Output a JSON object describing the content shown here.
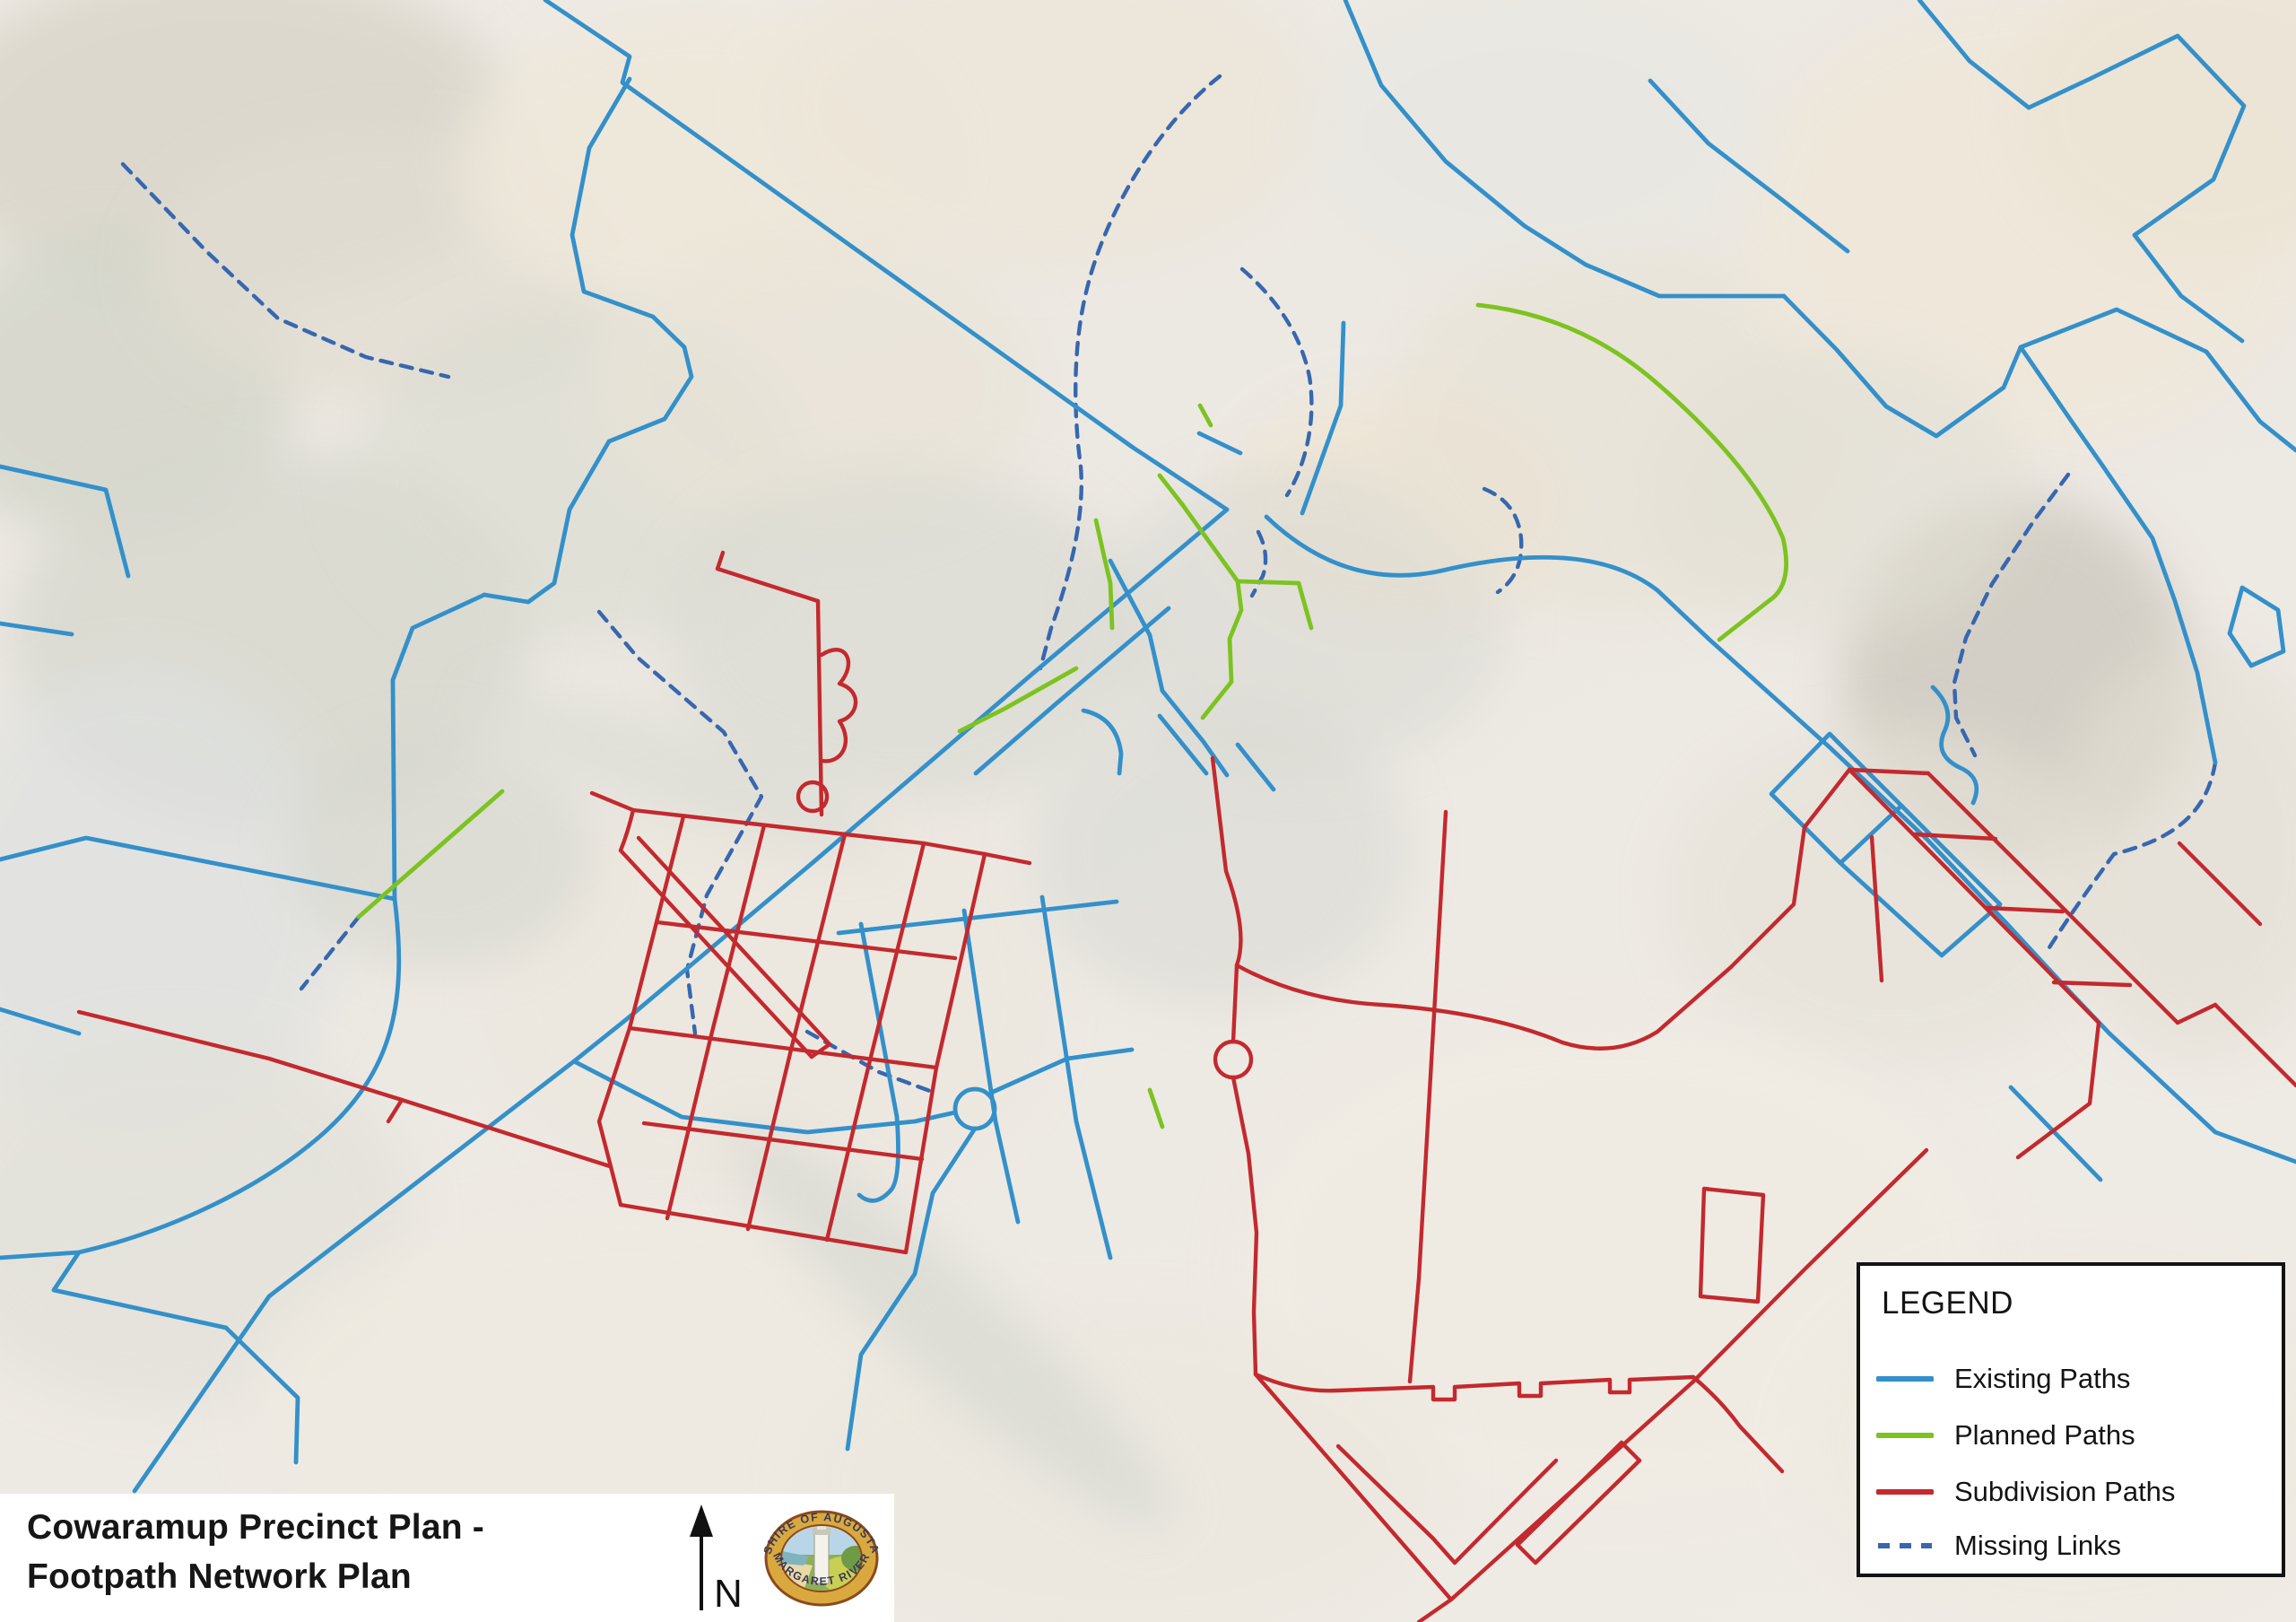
{
  "title": {
    "line1": "Cowaramup Precinct Plan -",
    "line2": "Footpath Network Plan"
  },
  "north": {
    "label": "N"
  },
  "logo": {
    "top_text": "SHIRE OF AUGUSTA",
    "bottom_text": "MARGARET RIVER"
  },
  "legend": {
    "heading": "LEGEND",
    "items": [
      {
        "label": "Existing Paths",
        "style": "solid",
        "color": "#3390CA"
      },
      {
        "label": "Planned Paths",
        "style": "solid",
        "color": "#7CC320"
      },
      {
        "label": "Subdivision Paths",
        "style": "solid",
        "color": "#C3292E"
      },
      {
        "label": "Missing Links",
        "style": "dashed",
        "color": "#3767AF"
      }
    ]
  },
  "map": {
    "colors": {
      "existing": "#3390CA",
      "planned": "#7CC320",
      "subdivision": "#C3292E",
      "missing": "#3767AF"
    },
    "layers": [
      {
        "key": "missing",
        "color": "#3767AF",
        "width": 4.4,
        "dash": "13 10"
      },
      {
        "key": "existing",
        "color": "#3390CA",
        "width": 4.8,
        "dash": null
      },
      {
        "key": "planned",
        "color": "#7CC320",
        "width": 4.8,
        "dash": null
      },
      {
        "key": "subdivision",
        "color": "#C3292E",
        "width": 4.4,
        "dash": null
      }
    ],
    "blobs": [
      [
        250,
        150,
        330,
        190,
        "#d9d6cb",
        0.85
      ],
      [
        120,
        430,
        210,
        170,
        "#d3d5ca",
        0.8
      ],
      [
        430,
        300,
        270,
        150,
        "#e2ddd2",
        0.7
      ],
      [
        780,
        180,
        270,
        170,
        "#efe8da",
        0.8
      ],
      [
        1160,
        120,
        310,
        180,
        "#ece5d8",
        0.7
      ],
      [
        300,
        710,
        290,
        210,
        "#d6d7cd",
        0.75
      ],
      [
        150,
        1010,
        230,
        270,
        "#dfe1e0",
        0.7
      ],
      [
        190,
        1360,
        270,
        210,
        "#e2e1d9",
        0.7
      ],
      [
        640,
        530,
        250,
        190,
        "#dadbd0",
        0.6
      ],
      [
        910,
        430,
        250,
        170,
        "#e9e3d6",
        0.6
      ],
      [
        1010,
        710,
        270,
        190,
        "#d8d9d0",
        0.6
      ],
      [
        860,
        1110,
        310,
        230,
        "#ece7de",
        0.75
      ],
      [
        700,
        1560,
        420,
        210,
        "#efeae1",
        0.85
      ],
      [
        1360,
        950,
        210,
        170,
        "#d8d9d3",
        0.55
      ],
      [
        1560,
        560,
        185,
        125,
        "#efe6d7",
        0.95
      ],
      [
        1450,
        690,
        230,
        170,
        "#d7d8d1",
        0.5
      ],
      [
        1810,
        480,
        270,
        210,
        "#e8e2d4",
        0.6
      ],
      [
        2260,
        250,
        310,
        250,
        "#efe7da",
        0.9
      ],
      [
        2460,
        120,
        210,
        170,
        "#ece4d4",
        0.8
      ],
      [
        2250,
        760,
        195,
        205,
        "#cdc9bf",
        0.8
      ],
      [
        2110,
        1000,
        250,
        190,
        "#e5e2d8",
        0.6
      ],
      [
        1800,
        1410,
        420,
        270,
        "#f0ece3",
        0.85
      ],
      [
        2310,
        1610,
        310,
        210,
        "#efeae1",
        0.85
      ],
      [
        1250,
        1650,
        360,
        190,
        "#ece8df",
        0.75
      ],
      [
        2450,
        950,
        160,
        230,
        "#e3dfd4",
        0.6
      ],
      [
        1710,
        150,
        260,
        160,
        "#e7e7e1",
        0.55
      ],
      [
        2050,
        550,
        210,
        160,
        "#e1dfd4",
        0.55
      ],
      [
        490,
        950,
        170,
        130,
        "#d4d6cd",
        0.6
      ],
      [
        1060,
        1480,
        330,
        60,
        "#d7d9d1",
        0.7,
        42
      ],
      [
        760,
        860,
        240,
        50,
        "#d8dad2",
        0.6,
        18
      ]
    ],
    "paths": {
      "existing": [
        "M608,0 L702,63 L694,92 L1262,498 L1368,568",
        "M1368,568 L1150,752 L908,960 L700,1135 L640,1183",
        "M640,1183 L300,1445 L150,1662",
        "M640,1183 L760,1245 L900,1262 L1020,1250 L1065,1240",
        "M1065,1236 a22,22 0 1 0 44,0 a22,22 0 1 0 -44,0",
        "M1105,1218 L1190,1180 L1262,1170",
        "M1087,1258 L1040,1330 L1020,1420 L960,1510 L945,1615",
        "M702,88 L657,165 L638,262 L651,325 L728,353 L763,387 L771,420 L741,467 L679,492 L635,568 L618,650 L589,671 L540,663",
        "M540,663 L460,700 L438,758 L440,1002",
        "M0,958 L96,934 L440,1002",
        "M0,520 L118,546 L143,642",
        "M0,695 L80,707",
        "M0,1125 L88,1152",
        "M440,1002 C455,1120 436,1195 362,1262 C295,1322 192,1372 88,1396 L0,1402",
        "M88,1396 L60,1438 L252,1480",
        "M252,1480 L332,1558 L330,1630",
        "M960,1030 L1000,1245 Q1005,1315 993,1327 Q975,1347 958,1332",
        "M1075,1015 L1110,1250 L1135,1362",
        "M1162,1000 L1200,1250 L1238,1402",
        "M935,1040 L1245,1005",
        "M1303,678 L1178,784 L1088,862",
        "M1238,625 L1282,708 L1296,770 L1342,827 L1368,864",
        "M1412,576 Q1500,660 1608,636 Q1770,598 1848,658 L1905,712",
        "M1452,572 L1495,452 L1498,360",
        "M1337,483 L1383,505",
        "M1293,798 L1345,862",
        "M1208,792 Q1245,800 1250,840 L1248,862",
        "M1380,830 L1420,880",
        "M1905,712 L2040,833 L2148,935 L2238,1030 L2312,1110 L2352,1152",
        "M2352,1152 L2470,1262 L2560,1295",
        "M2242,1212 L2342,1315",
        "M1500,0 L1540,95 L1612,180 L1700,252 L1768,295",
        "M1768,295 L1850,330 L1989,330",
        "M1840,90 L1905,160 L1990,225 L2060,280",
        "M1989,330 L2048,390 L2103,453 L2159,486 L2234,432 L2253,387",
        "M2253,387 L2360,345 L2460,392",
        "M2460,392 L2520,470 L2560,502",
        "M2140,0 L2196,68 L2262,120",
        "M2262,120 L2330,88 L2428,40 L2502,118 L2468,200 L2380,262",
        "M2380,262 L2432,330 L2500,380",
        "M2253,387 L2310,470 L2345,520",
        "M2345,520 L2400,600 L2425,670 L2450,750 L2470,850",
        "M2500,655 L2540,680 L2546,726 L2510,742 L2486,706 Z",
        "M1975,885 L2040,818 L2120,898 L2052,962 Z",
        "M2120,898 L2230,1008 L2165,1065 L2052,962",
        "M2155,766 Q2180,790 2168,815 Q2156,842 2186,856 Q2212,868 2200,895"
      ],
      "planned": [
        "M1648,340 Q1760,352 1845,425 Q1955,520 1988,600 Q2000,652 1972,670 Q1944,692 1917,713",
        "M1293,530 L1318,562",
        "M1318,562 L1380,648 L1384,680 L1371,712 L1373,760 L1341,800",
        "M1380,648 L1448,650 L1462,700",
        "M1222,580 L1231,620 L1238,650 L1240,700",
        "M1200,745 L1120,790 L1070,815",
        "M400,1022 L560,882",
        "M1282,1215 L1296,1256",
        "M1338,452 L1350,474"
      ],
      "missing": [
        "M137,183 L230,280 L310,355 L408,398 L500,420",
        "M668,682 L711,733 L807,816 L849,888 L788,998 L766,1081 L775,1152",
        "M400,1022 L336,1102",
        "M900,1150 L980,1195 L1042,1218",
        "M1360,85 C1290,140 1230,240 1210,330 C1195,395 1198,470 1205,520 C1210,580 1190,650 1172,700 L1160,745",
        "M1385,300 C1420,330 1450,370 1460,420 C1468,470 1455,520 1435,552",
        "M1403,593 Q1416,618 1408,642 L1396,664",
        "M1655,545 Q1692,560 1696,600 Q1699,640 1670,660",
        "M2306,529 L2268,580 L2221,651 L2192,711 L2179,761 L2181,800 L2202,842",
        "M2470,850 C2460,910 2420,936 2357,952 C2322,1000 2300,1032 2280,1064"
      ],
      "subdivision": [
        "M800,634 L806,616",
        "M800,634 L912,670",
        "M912,670 L916,908",
        "M916,730 C944,712 956,740 936,762 C962,770 958,798 936,804 C952,828 938,852 916,848",
        "M890,888 a16,16 0 1 0 32,0 a16,16 0 1 0 -32,0",
        "M660,884 L706,903 L1030,940 L1098,952",
        "M706,903 Q700,928 692,948",
        "M692,948 L905,1178",
        "M712,934 L925,1164",
        "M905,1178 L925,1164",
        "M762,910 L702,1146",
        "M852,920 L792,1158",
        "M942,930 L882,1170",
        "M1030,940 L970,1182",
        "M702,1146 L1044,1190",
        "M733,1028 L1065,1068",
        "M792,1158 L744,1358",
        "M882,1170 L834,1370",
        "M970,1182 L922,1382",
        "M692,1343 L1010,1396",
        "M702,1146 L668,1250 L692,1343",
        "M1044,1190 L1010,1396",
        "M1098,952 L1044,1190",
        "M88,1128 L300,1180 L448,1226",
        "M448,1226 L433,1250",
        "M448,1226 L680,1300",
        "M1098,952 L1148,962",
        "M718,1252 L1028,1292",
        "M1352,845 L1367,971 Q1392,1040 1379,1076 L1375,1161",
        "M1355,1181 a20,20 0 1 0 40,0 a20,20 0 1 0 -40,0",
        "M1375,1201 L1392,1286 L1401,1374 L1398,1462 L1400,1532",
        "M1400,1532 L1618,1783",
        "M1618,1783 L1888,1540",
        "M1888,1540 L2012,1415 L2148,1282",
        "M1618,1783 L1582,1808",
        "M1612,905 L1582,1425 L1572,1540",
        "M1379,1076 Q1450,1115 1540,1120 Q1660,1128 1742,1162 Q1800,1180 1848,1150 L1930,1078",
        "M1400,1532 Q1445,1552 1490,1550 L1598,1546 l0,14 l24,0 l0,-14 L1694,1542 l0,14 l24,0 l0,-14 L1795,1538 l0,14 l22,0 l0,-14 L1888,1535",
        "M1888,1535 Q1918,1560 1940,1590 L1987,1640",
        "M1492,1612 L1598,1715 L1622,1742",
        "M1622,1742 L1705,1658 L1735,1628",
        "M1692,1722 L1808,1608",
        "M1712,1742 L1828,1628",
        "M1808,1608 L1828,1628",
        "M1692,1722 L1712,1742",
        "M1930,1078 L2000,1008 L2012,922 L2062,858",
        "M2062,858 L2220,1018 L2340,1140",
        "M2150,862 L2310,1022 L2428,1140",
        "M2062,858 L2150,862",
        "M2135,930 L2225,935",
        "M2215,1012 L2300,1016",
        "M2290,1095 L2375,1098",
        "M2340,1140 L2330,1230 L2250,1290",
        "M1900,1325 L1966,1332 L1960,1451 L1896,1445 Z",
        "M2430,940 L2520,1030",
        "M2470,1120 L2560,1210",
        "M2428,1140 L2470,1120",
        "M2087,933 L2098,1093"
      ]
    }
  }
}
